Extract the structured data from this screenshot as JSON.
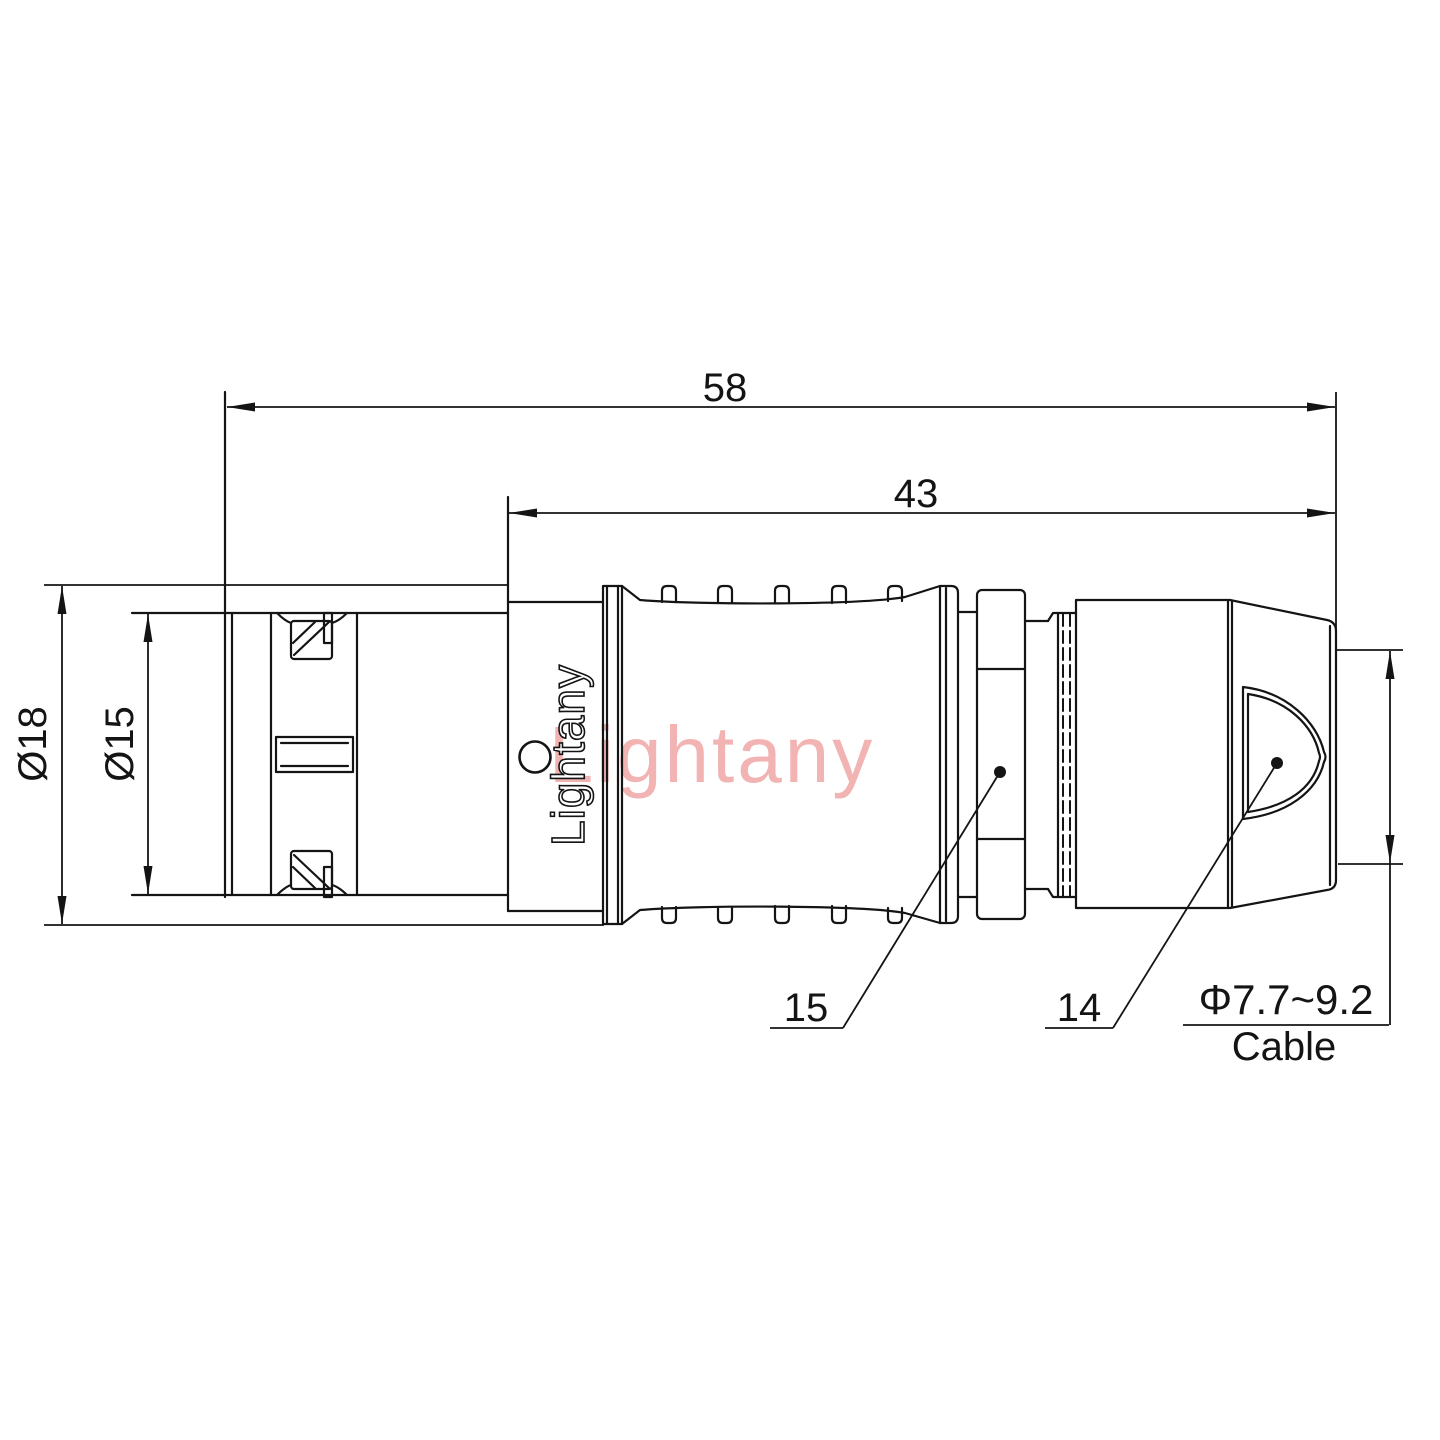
{
  "drawing": {
    "kind": "push-pull circular connector straight plug, side elevation technical drawing",
    "brand_text": "Lightany",
    "watermark_text": "Lightany"
  },
  "dims": {
    "overall_length": "58",
    "rear_length": "43",
    "outer_diameter": "Ø18",
    "front_diameter": "Ø15",
    "part_number_nut": "15",
    "part_number_boot": "14",
    "cable_diameter_range": "Φ7.7~9.2",
    "cable_word": "Cable"
  },
  "colors": {
    "line": "#141414",
    "background": "#ffffff",
    "watermark": "#f2b3b3"
  }
}
